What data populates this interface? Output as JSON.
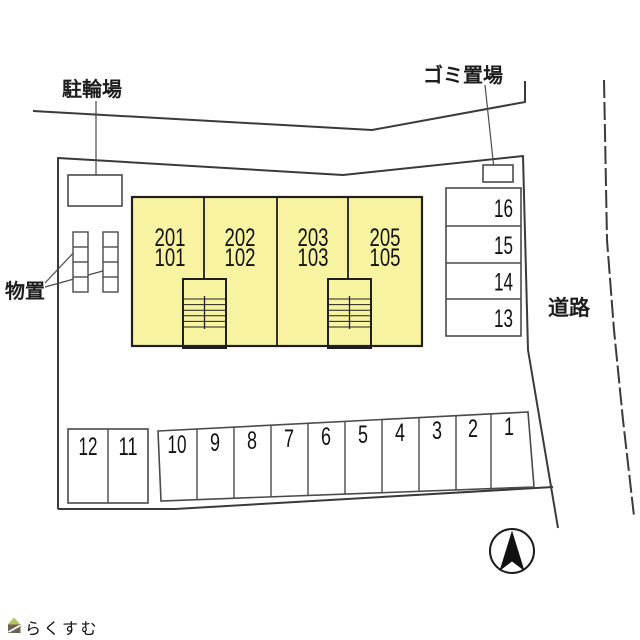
{
  "labels": {
    "bicycle_parking": "駐輪場",
    "garbage_area": "ゴミ置場",
    "storage": "物置",
    "road": "道路"
  },
  "colors": {
    "line": "#3a3a3a",
    "building_fill": "#f8f3a1"
  },
  "building": {
    "units": [
      {
        "upper": "201",
        "lower": "101"
      },
      {
        "upper": "202",
        "lower": "102"
      },
      {
        "upper": "203",
        "lower": "103"
      },
      {
        "upper": "205",
        "lower": "105"
      }
    ]
  },
  "parking": {
    "right_column": [
      "16",
      "15",
      "14",
      "13"
    ],
    "left_group": [
      "12",
      "11"
    ],
    "bottom_row": [
      "10",
      "9",
      "8",
      "7",
      "6",
      "5",
      "4",
      "3",
      "2",
      "1"
    ]
  },
  "logo": {
    "text": "らくすむ",
    "color": "#8d8077",
    "roof_color": "#b6c35e",
    "body_color": "#6d6257"
  }
}
